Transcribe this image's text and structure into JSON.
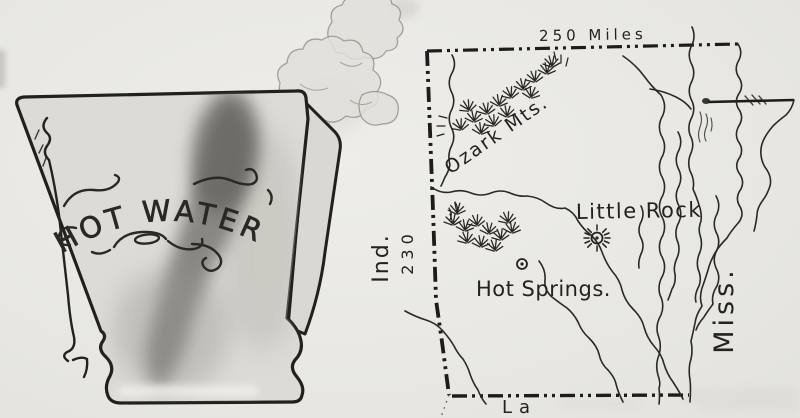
{
  "illustration": {
    "pitcher": {
      "label": "HOT WATER"
    },
    "map": {
      "scale_top_label": "250 Miles",
      "scale_left_label": "230",
      "neighbor_west_label": "Ind.",
      "neighbor_east_label": "Miss.",
      "neighbor_south_label": "La",
      "mountains_label": "Ozark Mts.",
      "little_rock_label": "Little Rock",
      "hot_springs_label": "Hot Springs.",
      "markers": {
        "little_rock": "sunburst-icon",
        "hot_springs": "circle-dot-icon"
      }
    },
    "colors": {
      "paper": "#eae9e4",
      "ink": "#232220",
      "pitcher_fill": "#dcdbd6",
      "smudge": "#6e6c66",
      "steam": "#e0dfd9"
    }
  }
}
